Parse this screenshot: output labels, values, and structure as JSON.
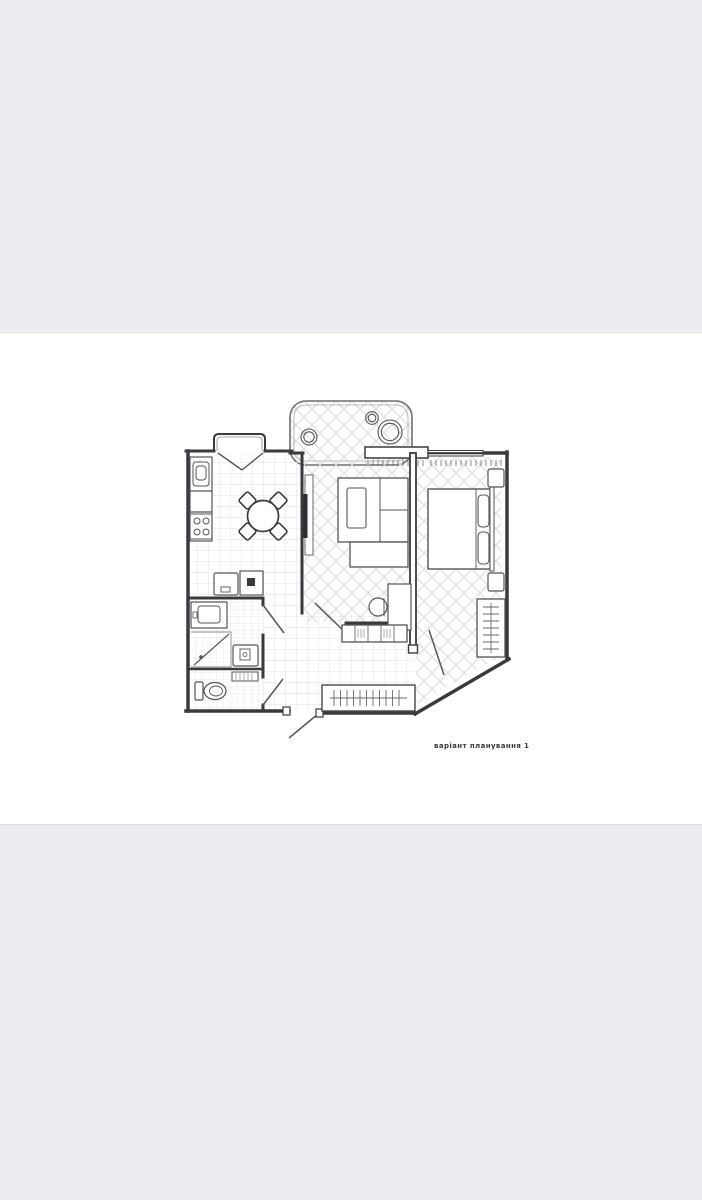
{
  "window": {
    "background_color": "#ececf1",
    "sheet_color": "#ffffff"
  },
  "plan": {
    "caption": "варіант планування 1",
    "line_color": "#3a3a3e",
    "pattern_color": "#d6d6da",
    "rooms": [
      {
        "name": "balcony"
      },
      {
        "name": "kitchen-dining"
      },
      {
        "name": "living-room"
      },
      {
        "name": "bedroom"
      },
      {
        "name": "hallway"
      },
      {
        "name": "bathroom"
      },
      {
        "name": "wc"
      }
    ],
    "furniture": [
      "kitchen-counter-icon",
      "sink-icon",
      "hob-icon",
      "dining-table-icon",
      "chair-icon",
      "washing-machine-icon",
      "oven-icon",
      "tv-icon",
      "tv-console-icon",
      "sofa-icon",
      "desk-icon",
      "desk-chair-icon",
      "sideboard-icon",
      "bed-icon",
      "pillow-icon",
      "nightstand-icon",
      "wardrobe-icon",
      "hanger-rail-icon",
      "plant-icon",
      "vanity-sink-icon",
      "shower-icon",
      "toilet-icon",
      "radiator-icon",
      "door-icon",
      "window-icon"
    ]
  }
}
